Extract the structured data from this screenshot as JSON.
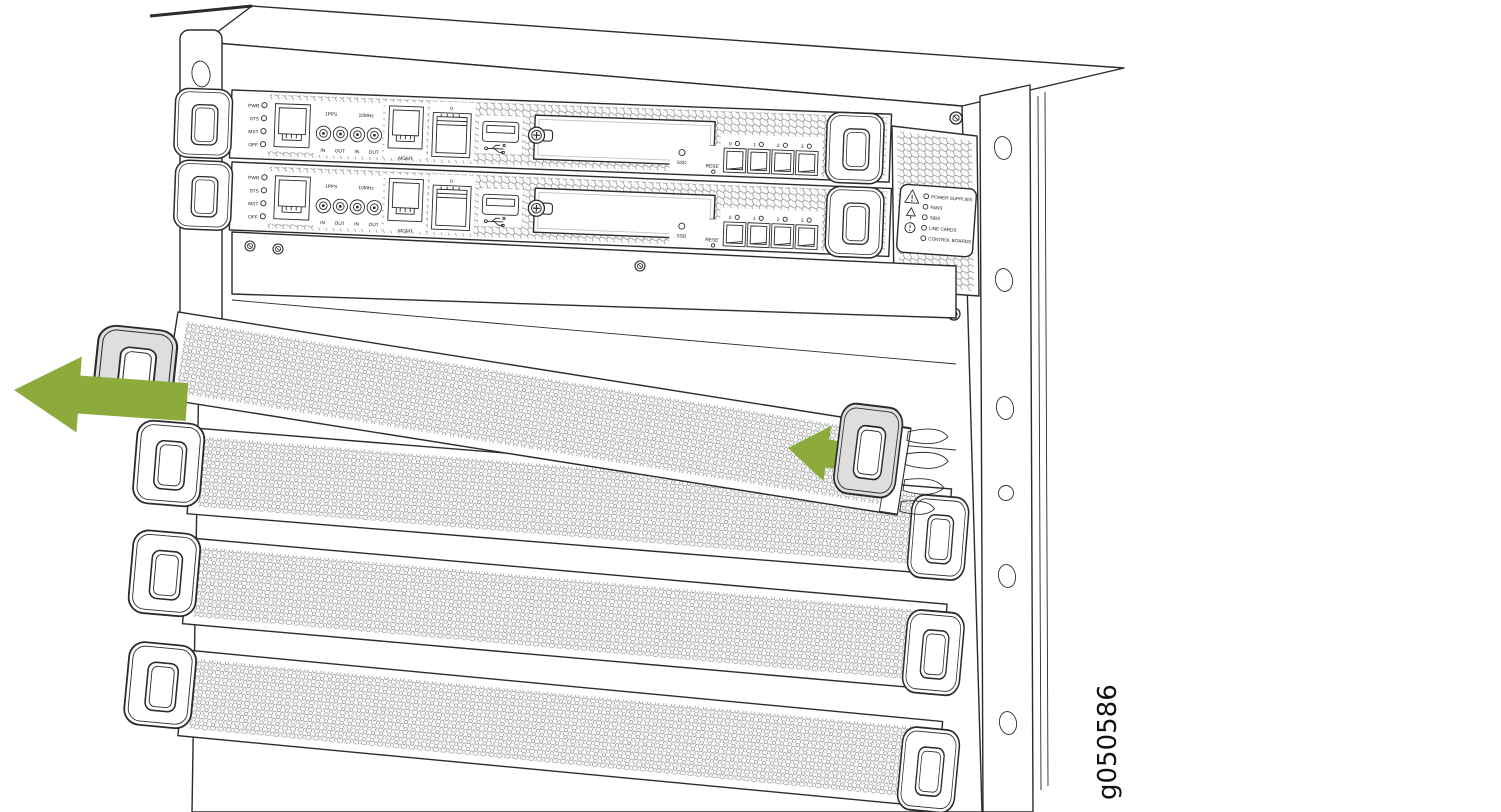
{
  "figure": {
    "id_label": "g050586"
  },
  "routing_engine": {
    "led_labels": [
      "PWR",
      "STS",
      "MST",
      "OFF"
    ],
    "timing_group_labels": [
      "1PPS",
      "10MHz"
    ],
    "timing_port_labels": [
      "IN",
      "OUT",
      "IN",
      "OUT"
    ],
    "mgmt_port_label": "MGMT",
    "sfp_port_label": "0",
    "ssd_led_label": "SSD",
    "reset_button_label": "RESET",
    "uplink_port_labels": [
      "0",
      "1",
      "2",
      "3"
    ]
  },
  "alarm_led_panel": {
    "led_labels": [
      "POWER SUPPLIES",
      "FANS",
      "SIBS",
      "LINE CARDS",
      "CONTROL BOARDS"
    ]
  },
  "colors": {
    "arrow_green": "#8CAB3C",
    "line_ink": "#2B2B2B",
    "handle_gray": "#DEDEDE"
  }
}
